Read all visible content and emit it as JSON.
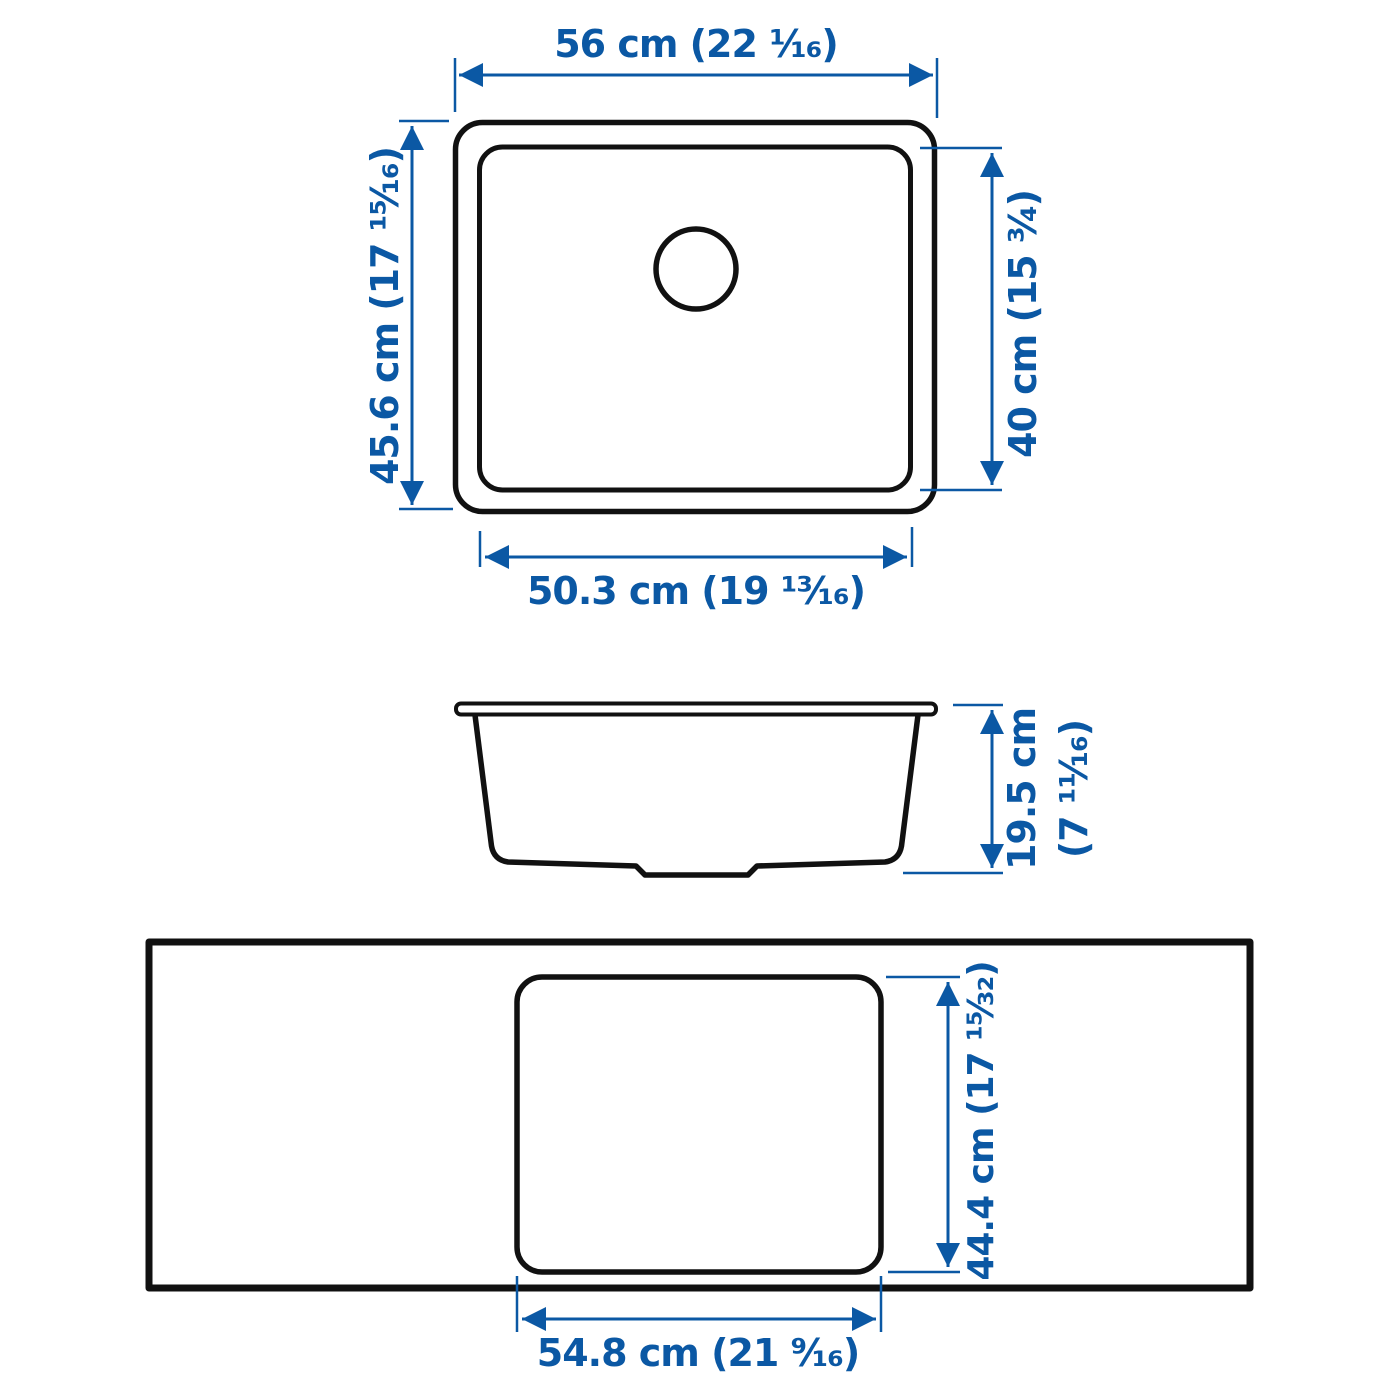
{
  "diagram_title": "Undermount sink measurement diagram",
  "colors": {
    "dimension_blue": "#0b58a4",
    "outline_black": "#111111",
    "background": "#ffffff"
  },
  "top_view": {
    "width_top": "56 cm (22 ¹⁄₁₆)",
    "height_left": "45.6 cm (17 ¹⁵⁄₁₆)",
    "height_right": "40 cm (15 ³⁄₄)",
    "width_bottom": "50.3 cm (19 ¹³⁄₁₆)"
  },
  "side_view": {
    "height_line1": "19.5 cm",
    "height_line2": "(7 ¹¹⁄₁₆)"
  },
  "bottom_view": {
    "height_right": "44.4 cm (17 ¹⁵⁄₃₂)",
    "width_bottom": "54.8 cm (21 ⁹⁄₁₆)"
  }
}
